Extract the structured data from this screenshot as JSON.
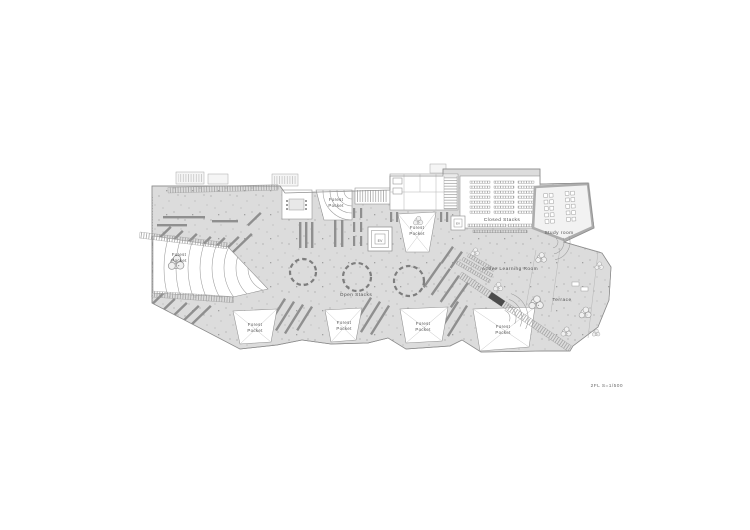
{
  "plan": {
    "caption": "2FL S=1/500",
    "labels": {
      "forest": "Forest",
      "pocket": "Pocket",
      "forest_pocket": "Forest Pocket",
      "open_stacks": "Open Stacks",
      "closed_stacks": "Closed Stacks",
      "study_room": "Study room",
      "active_learning_room": "Active Learning Room",
      "terrace": "Terrace",
      "elevator": "EV"
    },
    "colors": {
      "background": "#ffffff",
      "floor": "#dcdcdc",
      "shelf": "#8f8f8f",
      "wall": "#adadad",
      "line": "#9a9a9a",
      "text": "#4f4f4f"
    }
  }
}
